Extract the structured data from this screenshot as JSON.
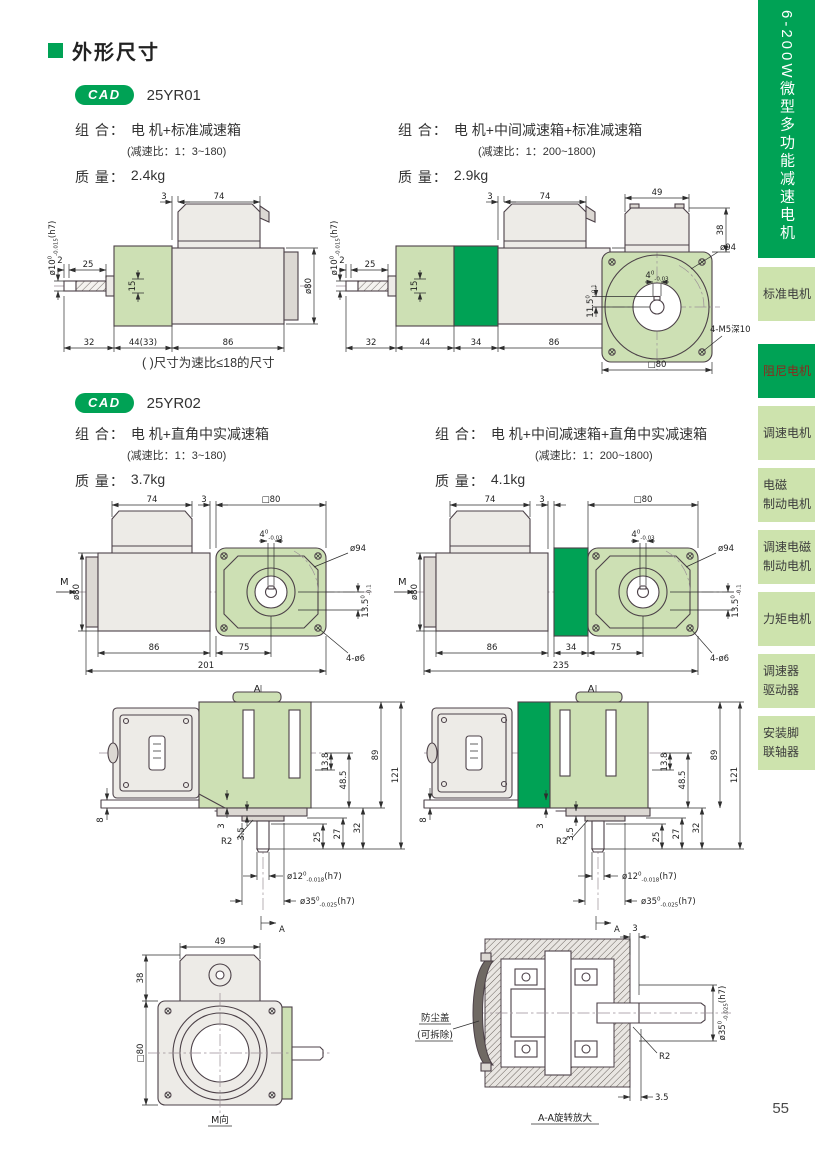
{
  "colors": {
    "accent": "#00a255",
    "drawing_fill": "#cde0b4",
    "line": "#4c4148"
  },
  "page_number": "55",
  "title": "外形尺寸",
  "sidebar": {
    "vertical_title": "6-200W微型多功能减速电机",
    "items": [
      {
        "label": "标准电机",
        "selected": false
      },
      {
        "label": "阻尼电机",
        "selected": true
      },
      {
        "label": "调速电机",
        "selected": false
      },
      {
        "label": "电磁\n制动电机",
        "selected": false
      },
      {
        "label": "调速电磁\n制动电机",
        "selected": false
      },
      {
        "label": "力矩电机",
        "selected": false
      },
      {
        "label": "调速器\n驱动器",
        "selected": false
      },
      {
        "label": "安装脚\n联轴器",
        "selected": false
      }
    ]
  },
  "sections": {
    "s1": {
      "badge": "CAD",
      "model": "25YR01",
      "left": {
        "combo_label": "组 合：",
        "combo": "电 机+标准减速箱",
        "ratio": "(减速比：1：3~180)",
        "mass_label": "质 量：",
        "mass": "2.4kg"
      },
      "right": {
        "combo_label": "组 合：",
        "combo": "电 机+中间减速箱+标准减速箱",
        "ratio": "(减速比：1：200~1800)",
        "mass_label": "质 量：",
        "mass": "2.9kg"
      },
      "note": "( )尺寸为速比≤18的尺寸"
    },
    "s2": {
      "badge": "CAD",
      "model": "25YR02",
      "left": {
        "combo_label": "组 合：",
        "combo": "电 机+直角中实减速箱",
        "ratio": "(减速比：1：3~180)",
        "mass_label": "质 量：",
        "mass": "3.7kg"
      },
      "right": {
        "combo_label": "组 合：",
        "combo": "电 机+中间减速箱+直角中实减速箱",
        "ratio": "(减速比：1：200~1800)",
        "mass_label": "质 量：",
        "mass": "4.1kg"
      }
    }
  },
  "tol": {
    "shaft10": {
      "pre": "ø10",
      "sup": "0",
      "sub": "-0.015",
      "post": "(h7)"
    },
    "key4": {
      "pre": "4",
      "sup": "0",
      "sub": "-0.03",
      "post": ""
    },
    "key115": {
      "pre": "11.5",
      "sup": "0",
      "sub": "-0.1",
      "post": ""
    },
    "key135": {
      "pre": "13.5",
      "sup": "0",
      "sub": "-0.1",
      "post": ""
    },
    "shaft12": {
      "pre": "ø12",
      "sup": "0",
      "sub": "-0.018",
      "post": "(h7)"
    },
    "shaft35": {
      "pre": "ø35",
      "sup": "0",
      "sub": "-0.025",
      "post": "(h7)"
    }
  },
  "drawings": {
    "d1": {
      "gap3": "3",
      "box74": "74",
      "s2": "2",
      "s25": "25",
      "mid15": "15",
      "dia80": "ø80",
      "b32": "32",
      "b44": "44(33)",
      "b86": "86"
    },
    "d2": {
      "gap3": "3",
      "box74": "74",
      "s2": "2",
      "s25": "25",
      "mid15": "15",
      "dia80": "ø80",
      "b32": "32",
      "b44": "44",
      "b34": "34",
      "b86": "86"
    },
    "f1": {
      "w49": "49",
      "h38": "38",
      "dia94": "ø94",
      "screws": "4-M5深10",
      "sq80": "□80"
    },
    "d3": {
      "m": "M",
      "box74": "74",
      "gap3": "3",
      "sq80": "□80",
      "dia80": "ø80",
      "dia94": "ø94",
      "holes": "4-ø6",
      "b86": "86",
      "b75": "75",
      "total": "201"
    },
    "d4": {
      "m": "M",
      "box74": "74",
      "gap3": "3",
      "sq80": "□80",
      "dia80": "ø80",
      "dia94": "ø94",
      "holes": "4-ø6",
      "b86": "86",
      "b34": "34",
      "b75": "75",
      "total": "235"
    },
    "d5": {
      "a": "A",
      "s8": "8",
      "s3": "3",
      "s35": "3.5",
      "r2": "R2",
      "v25": "25",
      "v27": "27",
      "v32": "32",
      "v138": "13.8",
      "v485": "48.5",
      "v89": "89",
      "v121": "121"
    },
    "d7": {
      "w49": "49",
      "h38": "38",
      "sq80": "□80",
      "label": "M向"
    },
    "d8": {
      "c1": "防尘盖",
      "c2": "(可拆除)",
      "t3": "3",
      "r2": "R2",
      "b35": "3.5",
      "label": "A-A旋转放大"
    }
  }
}
